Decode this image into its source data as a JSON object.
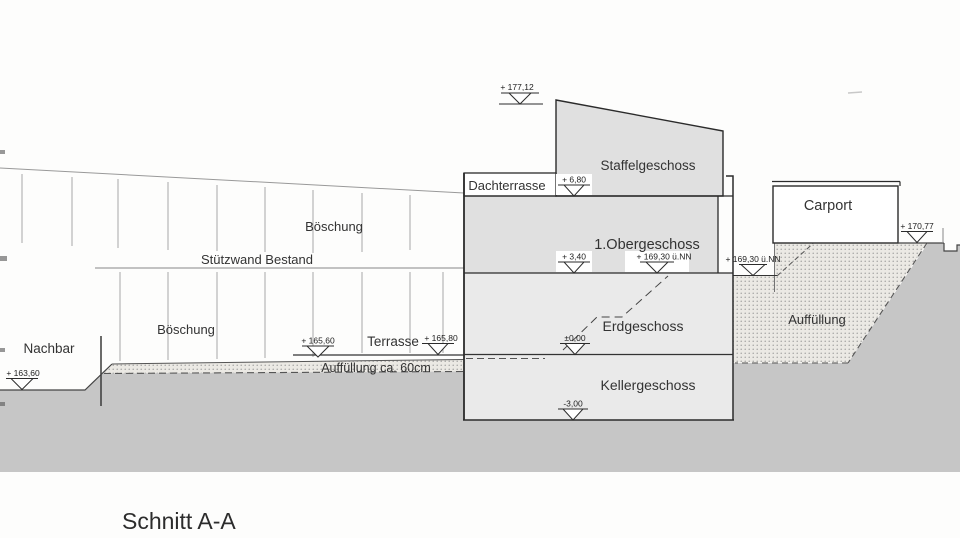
{
  "drawing_title": "Schnitt A-A",
  "labels": {
    "boeschung_upper": "Böschung",
    "stuetzwand_bestand": "Stützwand Bestand",
    "boeschung_lower": "Böschung",
    "nachbar": "Nachbar",
    "terrasse": "Terrasse",
    "auffuellung_strip": "Auffüllung ca. 60cm",
    "auffuellung_right": "Auffüllung",
    "dachterrasse": "Dachterrasse",
    "staffelgeschoss": "Staffelgeschoss",
    "obergeschoss": "1.Obergeschoss",
    "erdgeschoss": "Erdgeschoss",
    "kellergeschoss": "Kellergeschoss",
    "carport": "Carport"
  },
  "elevation_markers": {
    "roof": "+ 177,12",
    "staffel_floor": "+ 6,80",
    "og_floor": "+ 3,40",
    "og_floor_nn": "+ 169,30 ü.NN",
    "ground_right_nn": "+ 169,30 ü.NN",
    "carport_ground": "+ 170,77",
    "eg_floor": "±0,00",
    "kg_floor": "-3,00",
    "slope_foot": "+ 165,60",
    "terrace_level": "+ 165,80",
    "nachbar_ground": "+ 163,60"
  },
  "colors": {
    "page_bg": "#fdfdfc",
    "ground_gray": "#c6c6c6",
    "building_fill_upper": "#e0e0e0",
    "building_fill_lower": "#eaeaea",
    "stipple_base": "#ebe9e4",
    "stipple_dot": "#858585",
    "line_dark": "#2b2b2b",
    "white": "#ffffff"
  }
}
